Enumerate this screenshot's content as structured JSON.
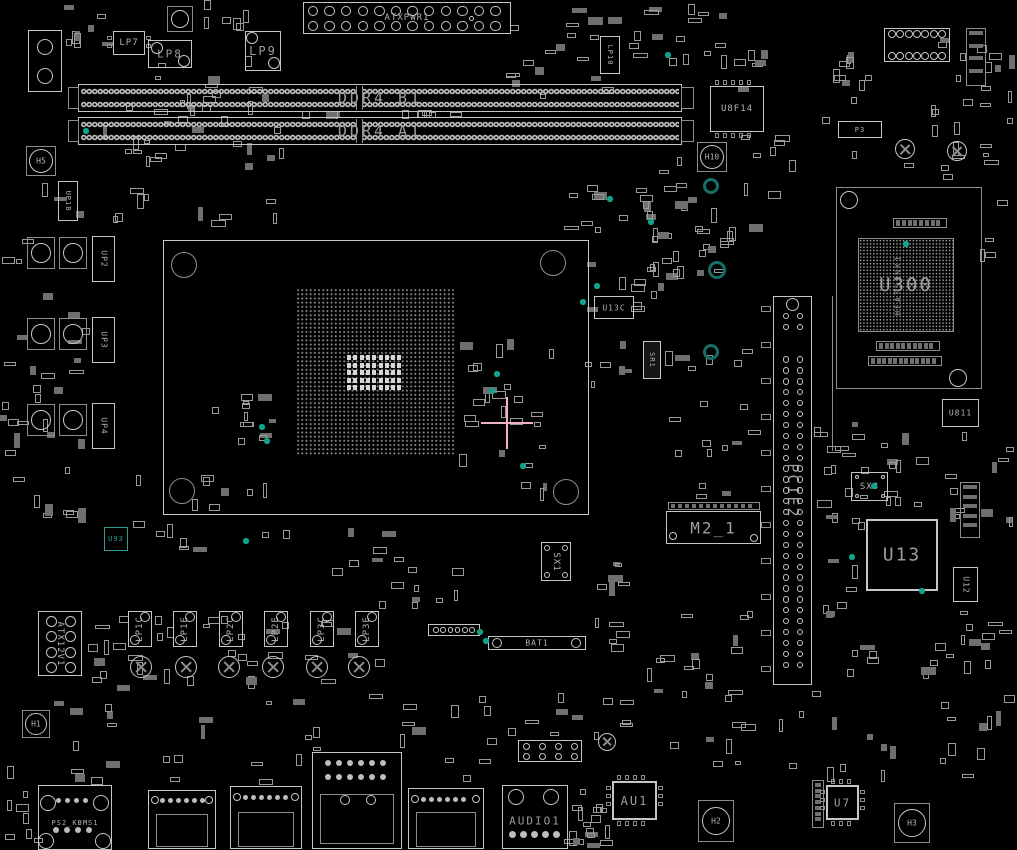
{
  "palette": {
    "bg": "#000000",
    "bright": "#c6c6c6",
    "dim": "#8d8d8d",
    "text": "#b3b3b3",
    "bigtext": "#9e9e9e",
    "fill": "#0b0b0b",
    "partfill": "#6f6f6f",
    "teal_ring": "#176e66",
    "teal_dot": "#12a38e",
    "teal_chip": "#2f9c90",
    "pink": "#f0b2bf",
    "pad": "#d6d6d6"
  },
  "components": [
    {
      "t": "atx",
      "label": "ATXPWR1",
      "x": 303,
      "y": 2,
      "w": 208,
      "h": 32
    },
    {
      "t": "io",
      "name": "corner-connector",
      "x": 28,
      "y": 30,
      "w": 34,
      "h": 62,
      "circles": [
        [
          45,
          47,
          8
        ],
        [
          45,
          76,
          8
        ]
      ]
    },
    {
      "t": "padc",
      "x": 167,
      "y": 6,
      "w": 26,
      "h": 26
    },
    {
      "t": "chip",
      "label": "LP7",
      "x": 113,
      "y": 31,
      "w": 32,
      "h": 24,
      "fs": 9,
      "pins": "lr"
    },
    {
      "t": "chip",
      "label": "LP8",
      "x": 148,
      "y": 40,
      "w": 44,
      "h": 28,
      "fs": 11,
      "circles": [
        [
          157,
          48,
          6
        ],
        [
          184,
          61,
          6
        ]
      ]
    },
    {
      "t": "chip",
      "label": "LP9",
      "x": 245,
      "y": 31,
      "w": 36,
      "h": 40,
      "fs": 12,
      "circles": [
        [
          252,
          38,
          6
        ],
        [
          274,
          63,
          6
        ]
      ]
    },
    {
      "t": "chip",
      "label": "LP10",
      "x": 600,
      "y": 36,
      "w": 20,
      "h": 38,
      "fs": 7,
      "rot": 1
    },
    {
      "t": "dimm",
      "label": "DDR4_B1",
      "x": 78,
      "y": 84,
      "w": 604,
      "h": 28
    },
    {
      "t": "dimm",
      "label": "DDR4_A1",
      "x": 78,
      "y": 117,
      "w": 604,
      "h": 28
    },
    {
      "t": "chip",
      "label": "U8F14",
      "x": 710,
      "y": 86,
      "w": 54,
      "h": 46,
      "fs": 9,
      "pins": "tb"
    },
    {
      "t": "chip",
      "label": "P3",
      "x": 838,
      "y": 121,
      "w": 44,
      "h": 17,
      "fs": 7
    },
    {
      "t": "hole",
      "label": "H10",
      "x": 697,
      "y": 142,
      "w": 30,
      "h": 30
    },
    {
      "t": "hole",
      "label": "H5",
      "x": 26,
      "y": 146,
      "w": 30,
      "h": 30
    },
    {
      "t": "screw",
      "x": 905,
      "y": 149,
      "r": 10
    },
    {
      "t": "screw",
      "x": 957,
      "y": 151,
      "r": 10
    },
    {
      "t": "io",
      "name": "heatsink-outline",
      "x": 836,
      "y": 187,
      "w": 146,
      "h": 202,
      "dimline": 1,
      "circles": [
        [
          849,
          200,
          9
        ],
        [
          958,
          378,
          9
        ]
      ]
    },
    {
      "t": "bga",
      "label": "U300",
      "sub": "HEATSINK1",
      "x": 858,
      "y": 238,
      "w": 96,
      "h": 94
    },
    {
      "t": "strip",
      "x": 893,
      "y": 218,
      "w": 54,
      "h": 10,
      "n": 8
    },
    {
      "t": "strip",
      "x": 876,
      "y": 341,
      "w": 64,
      "h": 10,
      "n": 10
    },
    {
      "t": "strip",
      "x": 868,
      "y": 356,
      "w": 74,
      "h": 10,
      "n": 12
    },
    {
      "t": "socket",
      "name": "cpu-socket",
      "x": 163,
      "y": 240,
      "w": 426,
      "h": 275,
      "grid": [
        296,
        288,
        160,
        168
      ],
      "pads": [
        347,
        355,
        56,
        37
      ],
      "circles": [
        [
          184,
          265,
          13
        ],
        [
          553,
          263,
          13
        ],
        [
          182,
          491,
          13
        ],
        [
          566,
          492,
          13
        ]
      ]
    },
    {
      "t": "chip",
      "label": "UP1B",
      "x": 58,
      "y": 181,
      "w": 20,
      "h": 40,
      "fs": 7,
      "rot": 1
    },
    {
      "t": "padc",
      "x": 27,
      "y": 237,
      "w": 28,
      "h": 32
    },
    {
      "t": "padc",
      "x": 59,
      "y": 237,
      "w": 28,
      "h": 32
    },
    {
      "t": "chip",
      "label": "UP2",
      "x": 92,
      "y": 236,
      "w": 23,
      "h": 46,
      "fs": 8,
      "rot": 1
    },
    {
      "t": "padc",
      "x": 27,
      "y": 318,
      "w": 28,
      "h": 32
    },
    {
      "t": "padc",
      "x": 59,
      "y": 318,
      "w": 28,
      "h": 32
    },
    {
      "t": "chip",
      "label": "UP3",
      "x": 92,
      "y": 317,
      "w": 23,
      "h": 46,
      "fs": 8,
      "rot": 1
    },
    {
      "t": "padc",
      "x": 27,
      "y": 404,
      "w": 28,
      "h": 32
    },
    {
      "t": "padc",
      "x": 59,
      "y": 404,
      "w": 28,
      "h": 32
    },
    {
      "t": "chip",
      "label": "UP4",
      "x": 92,
      "y": 403,
      "w": 23,
      "h": 46,
      "fs": 8,
      "rot": 1
    },
    {
      "t": "chip",
      "label": "U13C",
      "x": 594,
      "y": 296,
      "w": 40,
      "h": 23,
      "fs": 8
    },
    {
      "t": "chip",
      "label": "SR1",
      "x": 643,
      "y": 341,
      "w": 18,
      "h": 38,
      "fs": 7,
      "rot": 1,
      "fill": "#161616"
    },
    {
      "t": "pcie",
      "label": "PCIE2",
      "x": 773,
      "y": 296,
      "w": 39,
      "h": 389
    },
    {
      "t": "vline",
      "x": 832,
      "y": 296,
      "w": 1,
      "h": 155
    },
    {
      "t": "strip",
      "x": 668,
      "y": 502,
      "w": 92,
      "h": 8,
      "n": 12
    },
    {
      "t": "chip",
      "label": "M2_1",
      "x": 666,
      "y": 511,
      "w": 95,
      "h": 33,
      "fs": 16,
      "circles": [
        [
          673,
          536,
          4
        ],
        [
          754,
          538,
          4
        ]
      ]
    },
    {
      "t": "chip",
      "label": "U13",
      "x": 866,
      "y": 519,
      "w": 72,
      "h": 72,
      "fs": 18,
      "bw": 2
    },
    {
      "t": "chip",
      "label": "U811",
      "x": 942,
      "y": 399,
      "w": 37,
      "h": 28,
      "fs": 8
    },
    {
      "t": "chip",
      "label": "U12",
      "x": 953,
      "y": 567,
      "w": 25,
      "h": 35,
      "fs": 8,
      "rot": 1
    },
    {
      "t": "strip",
      "x": 960,
      "y": 482,
      "w": 20,
      "h": 56,
      "n": 5,
      "vert": 1
    },
    {
      "t": "strip",
      "x": 966,
      "y": 28,
      "w": 20,
      "h": 58,
      "n": 4,
      "vert": 1
    },
    {
      "t": "header",
      "x": 884,
      "y": 28,
      "w": 66,
      "h": 34,
      "rows": 2,
      "cols": 7,
      "r": 4
    },
    {
      "t": "chip",
      "label": "SX3",
      "x": 851,
      "y": 472,
      "w": 37,
      "h": 29,
      "fs": 9,
      "circles": [
        [
          857,
          477,
          2
        ],
        [
          883,
          477,
          2
        ],
        [
          857,
          496,
          2
        ],
        [
          883,
          496,
          2
        ]
      ]
    },
    {
      "t": "chip",
      "label": "SX1",
      "x": 541,
      "y": 542,
      "w": 30,
      "h": 39,
      "fs": 9,
      "rot": 1,
      "circles": [
        [
          547,
          548,
          3
        ],
        [
          565,
          548,
          3
        ],
        [
          547,
          575,
          3
        ],
        [
          565,
          575,
          3
        ]
      ]
    },
    {
      "t": "chip",
      "label": "U93",
      "x": 104,
      "y": 527,
      "w": 24,
      "h": 24,
      "fs": 7,
      "teal": 1
    },
    {
      "t": "atx12v",
      "label": "ATX12V1",
      "x": 38,
      "y": 611,
      "w": 44,
      "h": 65
    },
    {
      "t": "choke",
      "label": "LP1C",
      "x": 128,
      "y": 611,
      "w": 24,
      "h": 36
    },
    {
      "t": "choke",
      "label": "LP1E",
      "x": 173,
      "y": 611,
      "w": 24,
      "h": 36
    },
    {
      "t": "choke",
      "label": "LP2C",
      "x": 219,
      "y": 611,
      "w": 24,
      "h": 36
    },
    {
      "t": "choke",
      "label": "LP2E",
      "x": 264,
      "y": 611,
      "w": 24,
      "h": 36
    },
    {
      "t": "choke",
      "label": "LP3C",
      "x": 310,
      "y": 611,
      "w": 24,
      "h": 36
    },
    {
      "t": "choke",
      "label": "LP3E",
      "x": 355,
      "y": 611,
      "w": 24,
      "h": 36
    },
    {
      "t": "screw",
      "x": 141,
      "y": 667,
      "r": 11
    },
    {
      "t": "screw",
      "x": 186,
      "y": 667,
      "r": 11
    },
    {
      "t": "screw",
      "x": 229,
      "y": 667,
      "r": 11
    },
    {
      "t": "screw",
      "x": 273,
      "y": 667,
      "r": 11
    },
    {
      "t": "screw",
      "x": 317,
      "y": 667,
      "r": 11
    },
    {
      "t": "screw",
      "x": 359,
      "y": 667,
      "r": 11
    },
    {
      "t": "header",
      "x": 428,
      "y": 624,
      "w": 52,
      "h": 12,
      "rows": 1,
      "cols": 6,
      "r": 2.8
    },
    {
      "t": "battery",
      "label": "BAT1",
      "x": 488,
      "y": 636,
      "w": 98,
      "h": 14
    },
    {
      "t": "hole",
      "label": "H1",
      "x": 22,
      "y": 710,
      "w": 28,
      "h": 28
    },
    {
      "t": "header",
      "x": 518,
      "y": 740,
      "w": 64,
      "h": 22,
      "rows": 2,
      "cols": 4,
      "r": 3.5
    },
    {
      "t": "screw",
      "x": 607,
      "y": 742,
      "r": 9
    },
    {
      "t": "io",
      "label": "PS2_KBMS1",
      "fs": 7,
      "labelY": 37,
      "x": 38,
      "y": 785,
      "w": 74,
      "h": 65,
      "circles": [
        [
          48,
          803,
          8
        ],
        [
          101,
          803,
          8
        ],
        [
          46,
          841,
          8
        ],
        [
          103,
          841,
          8
        ]
      ],
      "dots": [
        [
          58,
          800,
          4,
          2.5,
          9
        ],
        [
          56,
          830,
          4,
          3,
          11
        ]
      ]
    },
    {
      "t": "io",
      "name": "usb-connector-1",
      "x": 148,
      "y": 790,
      "w": 68,
      "h": 59,
      "inner": [
        156,
        814,
        52,
        33
      ],
      "circles": [
        [
          155,
          800,
          4
        ],
        [
          209,
          800,
          4
        ]
      ],
      "dots": [
        [
          162,
          800,
          6,
          2.5,
          8
        ]
      ]
    },
    {
      "t": "io",
      "name": "usb-connector-2",
      "x": 230,
      "y": 786,
      "w": 72,
      "h": 63,
      "inner": [
        238,
        812,
        56,
        35
      ],
      "circles": [
        [
          237,
          797,
          4
        ],
        [
          295,
          797,
          4
        ]
      ],
      "dots": [
        [
          245,
          797,
          6,
          2.5,
          8
        ]
      ]
    },
    {
      "t": "io",
      "name": "lan-connector",
      "x": 312,
      "y": 752,
      "w": 90,
      "h": 97,
      "inner": [
        320,
        794,
        74,
        50
      ],
      "circles": [
        [
          345,
          800,
          5
        ],
        [
          371,
          800,
          5
        ]
      ],
      "dots": [
        [
          328,
          763,
          6,
          3,
          11
        ],
        [
          328,
          777,
          6,
          3,
          11
        ]
      ]
    },
    {
      "t": "io",
      "name": "usb-connector-3",
      "x": 408,
      "y": 788,
      "w": 76,
      "h": 61,
      "inner": [
        416,
        812,
        60,
        35
      ],
      "circles": [
        [
          415,
          799,
          4
        ],
        [
          476,
          799,
          4
        ]
      ],
      "dots": [
        [
          423,
          799,
          6,
          2.5,
          8
        ]
      ]
    },
    {
      "t": "io",
      "label": "AUDIO1",
      "fs": 11,
      "labelY": 35,
      "x": 502,
      "y": 785,
      "w": 66,
      "h": 64,
      "circles": [
        [
          516,
          797,
          8
        ],
        [
          551,
          797,
          8
        ]
      ],
      "dots": [
        [
          512,
          834,
          5,
          3.5,
          11
        ]
      ]
    },
    {
      "t": "chip",
      "label": "AU1",
      "x": 612,
      "y": 781,
      "w": 45,
      "h": 39,
      "fs": 12,
      "pins": "all",
      "bw": 2
    },
    {
      "t": "hole",
      "label": "H2",
      "x": 698,
      "y": 800,
      "w": 36,
      "h": 42
    },
    {
      "t": "strip",
      "x": 812,
      "y": 780,
      "w": 12,
      "h": 48,
      "n": 7,
      "vert": 1
    },
    {
      "t": "chip",
      "label": "U7",
      "x": 826,
      "y": 785,
      "w": 33,
      "h": 35,
      "fs": 11,
      "pins": "all",
      "bw": 2
    },
    {
      "t": "hole",
      "label": "H3",
      "x": 894,
      "y": 803,
      "w": 36,
      "h": 40
    }
  ],
  "clusters": [
    [
      100,
      52,
      190,
      178,
      46
    ],
    [
      300,
      110,
      210,
      9,
      10
    ],
    [
      505,
      0,
      120,
      100,
      18
    ],
    [
      620,
      0,
      120,
      70,
      14
    ],
    [
      700,
      40,
      70,
      55,
      8
    ],
    [
      820,
      30,
      195,
      150,
      30
    ],
    [
      545,
      182,
      150,
      112,
      22
    ],
    [
      585,
      298,
      80,
      92,
      10
    ],
    [
      620,
      218,
      95,
      85,
      12
    ],
    [
      660,
      300,
      110,
      200,
      18
    ],
    [
      205,
      390,
      78,
      58,
      12
    ],
    [
      455,
      328,
      102,
      180,
      26
    ],
    [
      0,
      178,
      90,
      420,
      36
    ],
    [
      118,
      448,
      185,
      105,
      16
    ],
    [
      300,
      528,
      135,
      82,
      10
    ],
    [
      408,
      548,
      65,
      62,
      6
    ],
    [
      586,
      598,
      190,
      100,
      20
    ],
    [
      100,
      688,
      420,
      98,
      28
    ],
    [
      520,
      688,
      120,
      55,
      10
    ],
    [
      560,
      806,
      55,
      44,
      8
    ],
    [
      660,
      688,
      145,
      85,
      12
    ],
    [
      800,
      688,
      215,
      100,
      18
    ],
    [
      813,
      392,
      62,
      120,
      12
    ],
    [
      880,
      430,
      60,
      85,
      10
    ],
    [
      814,
      500,
      52,
      125,
      12
    ],
    [
      940,
      430,
      75,
      100,
      12
    ],
    [
      845,
      618,
      170,
      62,
      12
    ],
    [
      585,
      552,
      62,
      48,
      6
    ],
    [
      640,
      148,
      62,
      62,
      8
    ],
    [
      740,
      128,
      62,
      75,
      8
    ],
    [
      975,
      55,
      42,
      210,
      12
    ],
    [
      150,
      615,
      215,
      26,
      12
    ],
    [
      85,
      598,
      58,
      105,
      10
    ],
    [
      50,
      700,
      70,
      92,
      8
    ],
    [
      120,
      648,
      275,
      42,
      14
    ],
    [
      60,
      0,
      58,
      50,
      8
    ],
    [
      196,
      0,
      85,
      32,
      6
    ],
    [
      690,
      200,
      80,
      95,
      10
    ],
    [
      960,
      610,
      57,
      75,
      8
    ],
    [
      0,
      750,
      45,
      95,
      8
    ],
    [
      568,
      786,
      40,
      64,
      10
    ]
  ],
  "rings": [
    [
      711,
      186,
      8
    ],
    [
      717,
      270,
      9
    ],
    [
      711,
      352,
      8
    ]
  ],
  "teal_dots": [
    [
      86,
      131
    ],
    [
      262,
      427
    ],
    [
      267,
      441
    ],
    [
      497,
      374
    ],
    [
      492,
      391
    ],
    [
      523,
      466
    ],
    [
      610,
      199
    ],
    [
      597,
      286
    ],
    [
      651,
      222
    ],
    [
      480,
      632
    ],
    [
      486,
      641
    ],
    [
      906,
      244
    ],
    [
      874,
      486
    ],
    [
      852,
      557
    ],
    [
      922,
      591
    ],
    [
      246,
      541
    ],
    [
      583,
      302
    ],
    [
      668,
      55
    ]
  ],
  "crosshair": {
    "x": 507,
    "y": 423,
    "arm": 26
  }
}
